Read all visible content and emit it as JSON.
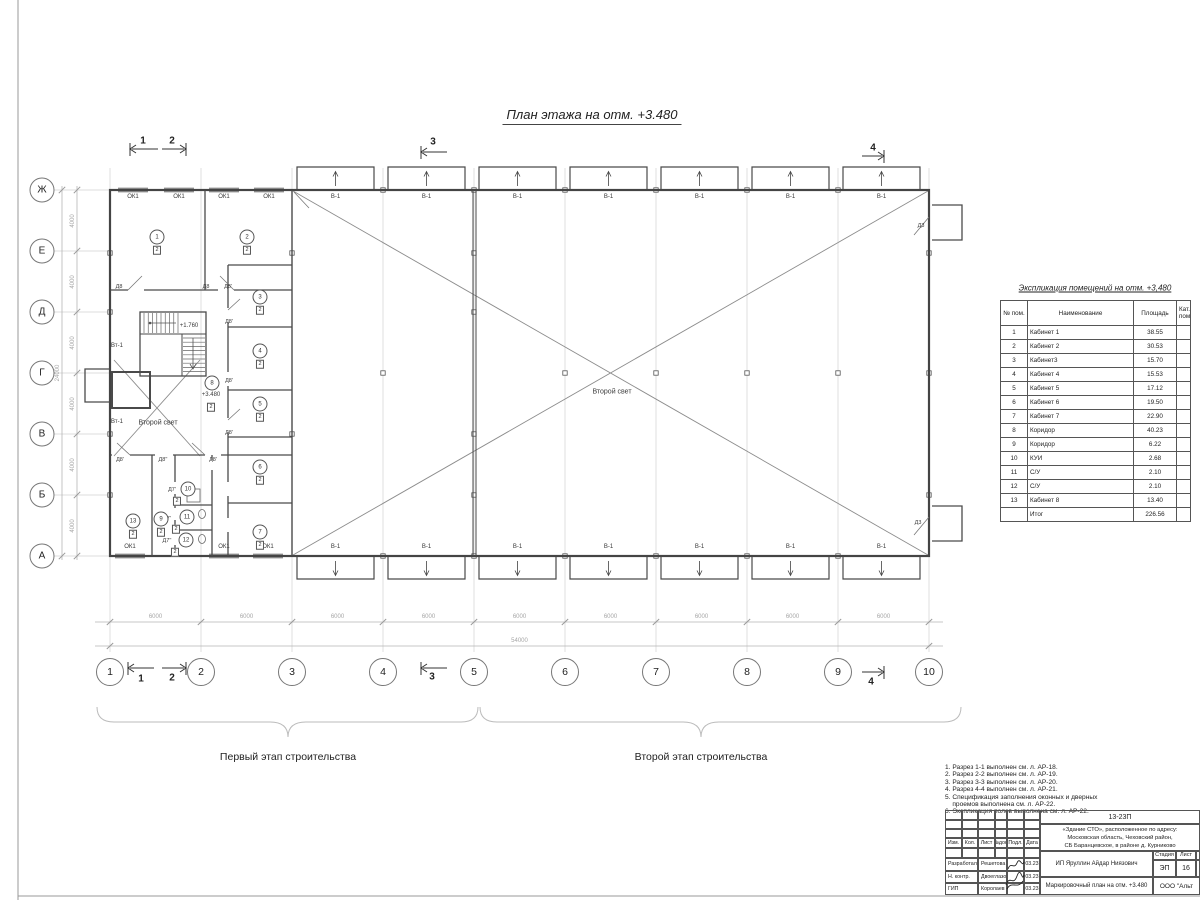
{
  "sheet_title": "План этажа на отм. +3.480",
  "axes": {
    "bottom": [
      "1",
      "2",
      "3",
      "4",
      "5",
      "6",
      "7",
      "8",
      "9",
      "10"
    ],
    "left": [
      "Ж",
      "Е",
      "Д",
      "Г",
      "В",
      "Б",
      "А"
    ]
  },
  "dimensions": {
    "bay": "6000",
    "total_width": "54000",
    "row": "4000",
    "total_height": "24000"
  },
  "section_marks": [
    "1",
    "2",
    "3",
    "4"
  ],
  "plan": {
    "window_label": "ОК1",
    "gate_label": "В-1",
    "door_labels": {
      "d8": "Д8",
      "d8s": "Д8'",
      "d8ss": "Д8''",
      "d7s": "Д7'",
      "d7ss": "Д7''",
      "d3": "Д3"
    },
    "vt_label": "Вт-1",
    "second_light": "Второй свет",
    "level_main": "+3.480",
    "level_stair": "+1.760",
    "rooms": [
      {
        "num": "1",
        "cat": "2"
      },
      {
        "num": "2",
        "cat": "2"
      },
      {
        "num": "3",
        "cat": "2"
      },
      {
        "num": "4",
        "cat": "2"
      },
      {
        "num": "5",
        "cat": "2"
      },
      {
        "num": "6",
        "cat": "2"
      },
      {
        "num": "7",
        "cat": "2"
      },
      {
        "num": "8",
        "cat": "2"
      },
      {
        "num": "9",
        "cat": "2"
      },
      {
        "num": "10",
        "cat": "2"
      },
      {
        "num": "11",
        "cat": "2"
      },
      {
        "num": "12",
        "cat": "2"
      },
      {
        "num": "13",
        "cat": "2"
      }
    ]
  },
  "stages": {
    "first": "Первый этап строительства",
    "second": "Второй этап строительства"
  },
  "legend_table": {
    "title": "Экспликация помещений на отм. +3,480",
    "headers": [
      "№ пом.",
      "Наименование",
      "Площадь",
      "Кат. пом."
    ],
    "rows": [
      [
        "1",
        "Кабинет 1",
        "38.55",
        ""
      ],
      [
        "2",
        "Кабинет 2",
        "30.53",
        ""
      ],
      [
        "3",
        "Кабинет3",
        "15.70",
        ""
      ],
      [
        "4",
        "Кабинет 4",
        "15.53",
        ""
      ],
      [
        "5",
        "Кабинет 5",
        "17.12",
        ""
      ],
      [
        "6",
        "Кабинет 6",
        "19.50",
        ""
      ],
      [
        "7",
        "Кабинет 7",
        "22.90",
        ""
      ],
      [
        "8",
        "Коридор",
        "40.23",
        ""
      ],
      [
        "9",
        "Коридор",
        "6.22",
        ""
      ],
      [
        "10",
        "КУИ",
        "2.68",
        ""
      ],
      [
        "11",
        "С/У",
        "2.10",
        ""
      ],
      [
        "12",
        "С/У",
        "2.10",
        ""
      ],
      [
        "13",
        "Кабинет 8",
        "13.40",
        ""
      ]
    ],
    "total": [
      "",
      "Итог",
      "226.56",
      ""
    ]
  },
  "notes": [
    "1. Разрез 1-1 выполнен см. л. АР-18.",
    "2. Разрез 2-2 выполнен см. л. АР-19.",
    "3. Разрез 3-3 выполнен см. л. АР-20.",
    "4. Разрез 4-4 выполнен см. л. АР-21.",
    "5. Спецификация заполнения оконных и дверных",
    "    проемов выполнена см. л. АР-22.",
    "6. Экспликация полов выполнена см. л. АР-22."
  ],
  "title_block": {
    "doc_number": "13-23П",
    "address_line1": "«Здание СТО», расположенное по адресу:",
    "address_line2": "Московская область, Чеховский район,",
    "address_line3": "СБ Баранцевское, в районе д. Курниково",
    "cols": {
      "izm": "Изм.",
      "kol": "Кол.",
      "list": "Лист",
      "ndok": "№док.",
      "podl": "Подл.",
      "data": "Дата"
    },
    "rows": [
      {
        "role": "Разработал",
        "name": "Решетова",
        "date": "03.23"
      },
      {
        "role": "Н. контр.",
        "name": "Двоеглазов",
        "date": "03.23"
      },
      {
        "role": "ГИП",
        "name": "Королаев",
        "date": "03.23"
      }
    ],
    "client": "ИП Яруллин Айдар Ниязович",
    "stage_label": "Стадия",
    "sheet_label": "Лист",
    "stage": "ЭП",
    "sheet": "16",
    "doc_title": "Маркировочный план на отм. +3.480",
    "company": "ООО \"Альт"
  }
}
